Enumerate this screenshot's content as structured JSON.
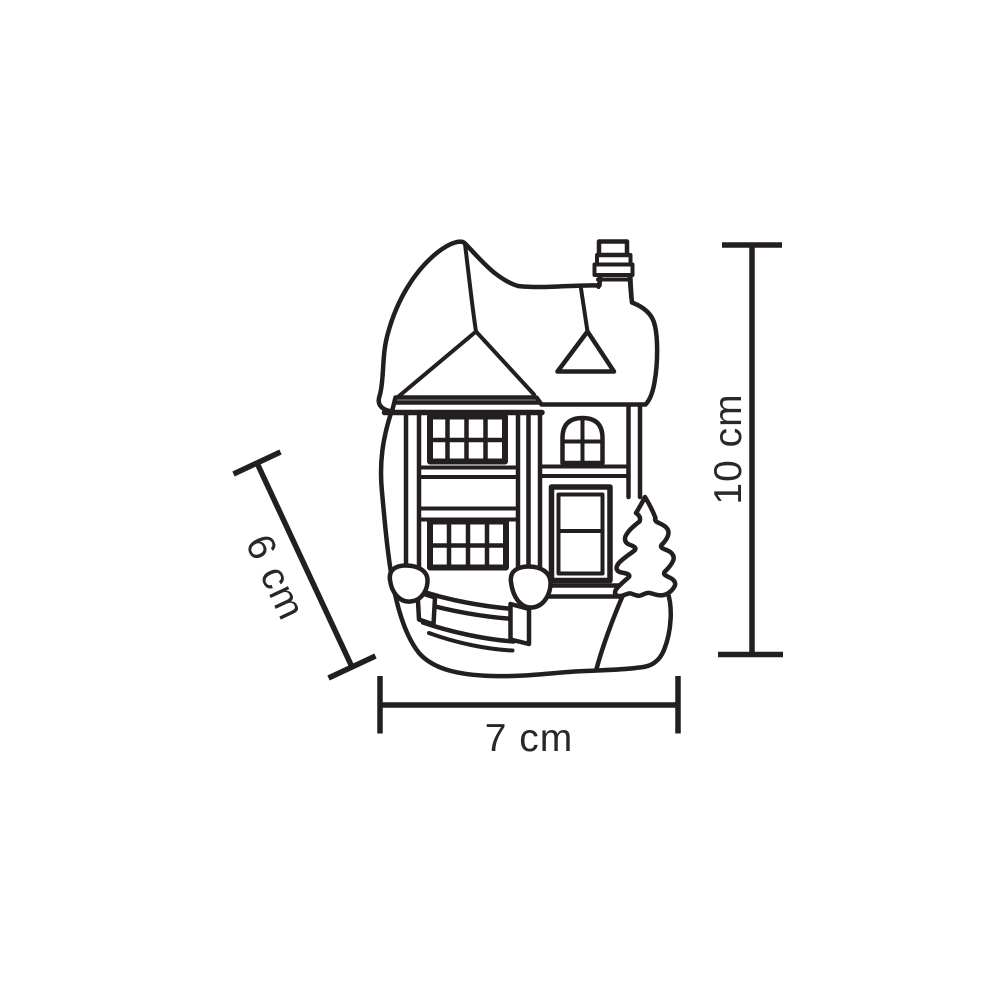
{
  "diagram": {
    "subject": "miniature house figurine line drawing with chimney, gabled roof, two multi-pane windows, arched window, panel door, garden fence with gate balls and pine tree",
    "line_color": "#231f20",
    "background_color": "#ffffff"
  },
  "dimensions": {
    "height": {
      "label": "10 cm"
    },
    "width": {
      "label": "7 cm"
    },
    "depth": {
      "label": "6 cm"
    }
  }
}
